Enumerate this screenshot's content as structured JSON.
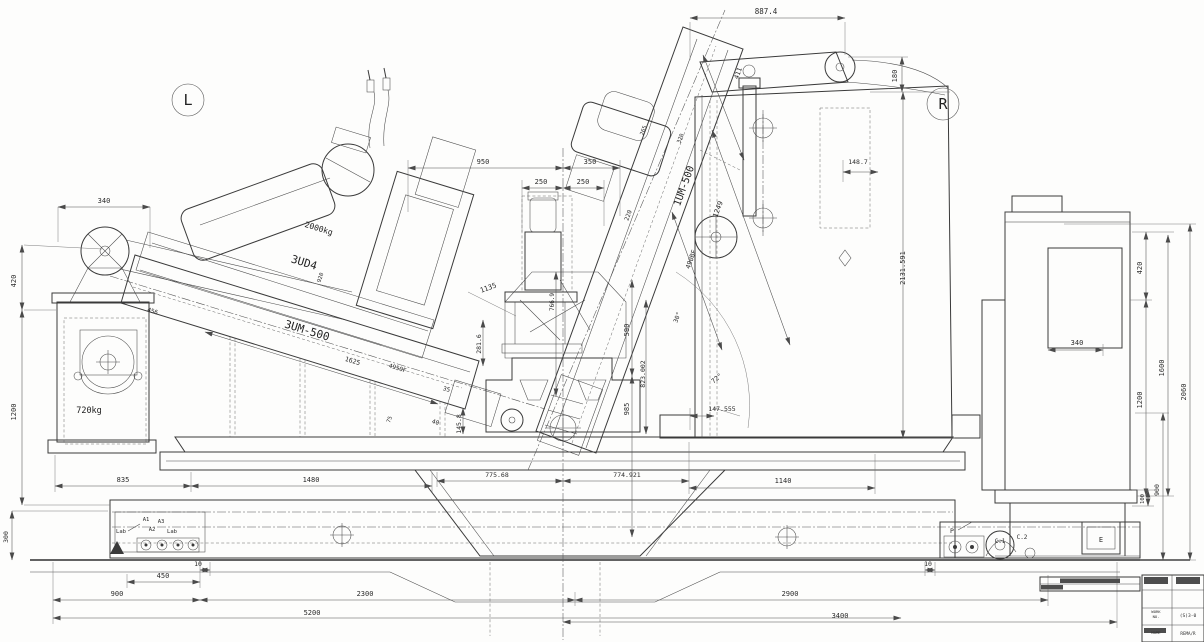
{
  "summary": {
    "view_left_marker": "L",
    "view_right_marker": "R",
    "left_machine": "3UM-500",
    "left_head": "3UD4",
    "right_machine": "1UM-500",
    "left_head_weight": "2000kg",
    "pedestal_weight": "720kg",
    "anchor_marks": [
      "Lab",
      "A1",
      "A2",
      "A3",
      "Lab",
      "P",
      "C.1",
      "C.2",
      "E"
    ]
  },
  "title_block": {
    "work_label": "WORK",
    "work_no_label": "NO.",
    "work_value": "(S)3-0",
    "name_label": "NAME",
    "name_value": "REMA/R"
  },
  "texts": [
    {
      "n": "view-label-left",
      "v": "L",
      "x": 188,
      "y": 105,
      "s": 15,
      "b": 1
    },
    {
      "n": "view-label-right",
      "v": "R",
      "x": 943,
      "y": 109,
      "s": 15,
      "b": 1
    },
    {
      "n": "dim-887-4",
      "v": "887.4",
      "x": 766,
      "y": 14,
      "s": 7.5
    },
    {
      "n": "dim-180",
      "v": "180",
      "x": 897,
      "y": 76,
      "r": -90,
      "s": 7
    },
    {
      "n": "dim-411",
      "v": "411",
      "x": 740,
      "y": 74,
      "r": -70,
      "s": 6.5
    },
    {
      "n": "dim-2131-591",
      "v": "2131.591",
      "x": 905,
      "y": 268,
      "r": -90,
      "s": 7
    },
    {
      "n": "dim-148-7",
      "v": "148.7",
      "x": 858,
      "y": 164,
      "s": 6.5
    },
    {
      "n": "label-1um-500",
      "v": "1UM-500",
      "x": 687,
      "y": 187,
      "r": -70,
      "s": 10,
      "b": 1
    },
    {
      "n": "dim-1249",
      "v": "1249",
      "x": 720,
      "y": 210,
      "r": -70,
      "s": 7
    },
    {
      "n": "dim-490bf",
      "v": "490BF",
      "x": 693,
      "y": 260,
      "r": -70,
      "s": 6.5
    },
    {
      "n": "dim-265",
      "v": "265",
      "x": 645,
      "y": 131,
      "r": -70,
      "s": 5.5
    },
    {
      "n": "dim-320",
      "v": "320",
      "x": 682,
      "y": 139,
      "r": -70,
      "s": 5.5
    },
    {
      "n": "dim-220",
      "v": "220",
      "x": 630,
      "y": 216,
      "r": -70,
      "s": 6
    },
    {
      "n": "dim-30deg",
      "v": "30°",
      "x": 679,
      "y": 318,
      "r": -70,
      "s": 6
    },
    {
      "n": "dim-72deg",
      "v": "72°",
      "x": 718,
      "y": 380,
      "r": -40,
      "s": 6.5
    },
    {
      "n": "dim-147-555",
      "v": "147.555",
      "x": 722,
      "y": 411,
      "s": 6.5
    },
    {
      "n": "dim-950",
      "v": "950",
      "x": 483,
      "y": 164,
      "s": 7
    },
    {
      "n": "dim-350",
      "v": "350",
      "x": 590,
      "y": 164,
      "s": 7
    },
    {
      "n": "dim-250-a",
      "v": "250",
      "x": 541,
      "y": 184,
      "s": 7
    },
    {
      "n": "dim-250-b",
      "v": "250",
      "x": 583,
      "y": 184,
      "s": 7
    },
    {
      "n": "dim-1135",
      "v": "1135",
      "x": 489,
      "y": 290,
      "r": -20,
      "s": 7
    },
    {
      "n": "dim-281-6",
      "v": "281.6",
      "x": 481,
      "y": 344,
      "r": -90,
      "s": 6.5
    },
    {
      "n": "dim-766-9",
      "v": "766.9",
      "x": 554,
      "y": 302,
      "r": -90,
      "s": 6
    },
    {
      "n": "dim-590",
      "v": "590",
      "x": 629,
      "y": 330,
      "r": -90,
      "s": 7
    },
    {
      "n": "dim-823-002",
      "v": "823.002",
      "x": 645,
      "y": 374,
      "r": -90,
      "s": 6.5
    },
    {
      "n": "dim-985",
      "v": "985",
      "x": 629,
      "y": 409,
      "r": -90,
      "s": 7
    },
    {
      "n": "label-2000kg",
      "v": "2000kg",
      "x": 318,
      "y": 231,
      "r": 17,
      "s": 8,
      "b": 1
    },
    {
      "n": "label-3ud4",
      "v": "3UD4",
      "x": 303,
      "y": 266,
      "r": 17,
      "s": 11,
      "b": 1
    },
    {
      "n": "dim-920",
      "v": "920",
      "x": 322,
      "y": 278,
      "r": -73,
      "s": 5.5
    },
    {
      "n": "label-3um-500",
      "v": "3UM-500",
      "x": 306,
      "y": 334,
      "r": 17,
      "s": 11,
      "b": 1
    },
    {
      "n": "dim-1625",
      "v": "1625",
      "x": 352,
      "y": 363,
      "r": 17,
      "s": 6.5
    },
    {
      "n": "dim-4950f",
      "v": "4950F",
      "x": 397,
      "y": 370,
      "r": 17,
      "s": 6
    },
    {
      "n": "dim-456",
      "v": "456",
      "x": 152,
      "y": 313,
      "r": 17,
      "s": 6
    },
    {
      "n": "dim-35",
      "v": "35",
      "x": 446,
      "y": 391,
      "r": 17,
      "s": 6
    },
    {
      "n": "dim-75",
      "v": "75",
      "x": 391,
      "y": 420,
      "r": -70,
      "s": 5.5
    },
    {
      "n": "dim-40",
      "v": "40",
      "x": 435,
      "y": 424,
      "r": 17,
      "s": 6
    },
    {
      "n": "dim-145-8",
      "v": "145.8",
      "x": 461,
      "y": 424,
      "r": -90,
      "s": 6.5
    },
    {
      "n": "label-720kg",
      "v": "720kg",
      "x": 89,
      "y": 413,
      "s": 8.5,
      "b": 1
    },
    {
      "n": "dim-340-left",
      "v": "340",
      "x": 104,
      "y": 203,
      "s": 7
    },
    {
      "n": "dim-420-left",
      "v": "420",
      "x": 16,
      "y": 281,
      "r": -90,
      "s": 7
    },
    {
      "n": "dim-1200-left",
      "v": "1200",
      "x": 16,
      "y": 412,
      "r": -90,
      "s": 7
    },
    {
      "n": "dim-300-left",
      "v": "300",
      "x": 8,
      "y": 537,
      "r": -90,
      "s": 6.5
    },
    {
      "n": "dim-835",
      "v": "835",
      "x": 123,
      "y": 482,
      "s": 7
    },
    {
      "n": "dim-1480",
      "v": "1480",
      "x": 311,
      "y": 482,
      "s": 7
    },
    {
      "n": "dim-775-68",
      "v": "775.68",
      "x": 497,
      "y": 477,
      "s": 6.5
    },
    {
      "n": "dim-774-921",
      "v": "774.921",
      "x": 627,
      "y": 477,
      "s": 6.5
    },
    {
      "n": "dim-1140",
      "v": "1140",
      "x": 783,
      "y": 483,
      "s": 7
    },
    {
      "n": "anchor-lab-left",
      "v": "Lab",
      "x": 121,
      "y": 533,
      "s": 5.5
    },
    {
      "n": "anchor-a1",
      "v": "A1",
      "x": 146,
      "y": 521,
      "s": 5.5
    },
    {
      "n": "anchor-a3",
      "v": "A3",
      "x": 161,
      "y": 523,
      "s": 5.5
    },
    {
      "n": "anchor-a2",
      "v": "A2",
      "x": 152,
      "y": 531,
      "s": 5.5
    },
    {
      "n": "anchor-lab-right",
      "v": "Lab",
      "x": 172,
      "y": 533,
      "s": 5.5
    },
    {
      "n": "dim-10-left",
      "v": "10",
      "x": 198,
      "y": 566,
      "s": 6.5
    },
    {
      "n": "dim-450",
      "v": "450",
      "x": 163,
      "y": 578,
      "s": 7
    },
    {
      "n": "dim-900",
      "v": "900",
      "x": 117,
      "y": 596,
      "s": 7
    },
    {
      "n": "dim-2300",
      "v": "2300",
      "x": 365,
      "y": 596,
      "s": 7
    },
    {
      "n": "dim-5200",
      "v": "5200",
      "x": 312,
      "y": 615,
      "s": 7
    },
    {
      "n": "dim-2900",
      "v": "2900",
      "x": 790,
      "y": 596,
      "s": 7
    },
    {
      "n": "dim-3400",
      "v": "3400",
      "x": 840,
      "y": 618,
      "s": 7
    },
    {
      "n": "dim-10-right",
      "v": "10",
      "x": 928,
      "y": 566,
      "s": 6.5
    },
    {
      "n": "label-p",
      "v": "P",
      "x": 952,
      "y": 533,
      "s": 6.5
    },
    {
      "n": "label-c1",
      "v": "C.1",
      "x": 1000,
      "y": 543,
      "s": 6
    },
    {
      "n": "label-c2",
      "v": "C.2",
      "x": 1022,
      "y": 539,
      "s": 6
    },
    {
      "n": "label-e",
      "v": "E",
      "x": 1101,
      "y": 542,
      "s": 7
    },
    {
      "n": "dim-340-right",
      "v": "340",
      "x": 1077,
      "y": 345,
      "s": 7
    },
    {
      "n": "dim-420-right",
      "v": "420",
      "x": 1142,
      "y": 268,
      "r": -90,
      "s": 7
    },
    {
      "n": "dim-1200-right",
      "v": "1200",
      "x": 1142,
      "y": 400,
      "r": -90,
      "s": 7
    },
    {
      "n": "dim-1600",
      "v": "1600",
      "x": 1164,
      "y": 368,
      "r": -90,
      "s": 7
    },
    {
      "n": "dim-2060",
      "v": "2060",
      "x": 1186,
      "y": 392,
      "r": -90,
      "s": 7
    },
    {
      "n": "dim-100-right",
      "v": "100",
      "x": 1144,
      "y": 499,
      "r": -90,
      "s": 5.5
    },
    {
      "n": "dim-900-right",
      "v": "900",
      "x": 1159,
      "y": 490,
      "r": -90,
      "s": 6.5
    },
    {
      "n": "tb-work-label",
      "v": "WORK",
      "x": 1156,
      "y": 613,
      "s": 3.8
    },
    {
      "n": "tb-work-no-label",
      "v": "NO.",
      "x": 1156,
      "y": 618,
      "s": 3.8
    },
    {
      "n": "tb-work-value",
      "v": "(S)3-0",
      "x": 1188,
      "y": 617,
      "s": 4.6
    },
    {
      "n": "tb-name-label",
      "v": "NAME",
      "x": 1156,
      "y": 634,
      "s": 3.8
    },
    {
      "n": "tb-name-value",
      "v": "REMA/R",
      "x": 1188,
      "y": 635,
      "s": 4.2
    }
  ]
}
